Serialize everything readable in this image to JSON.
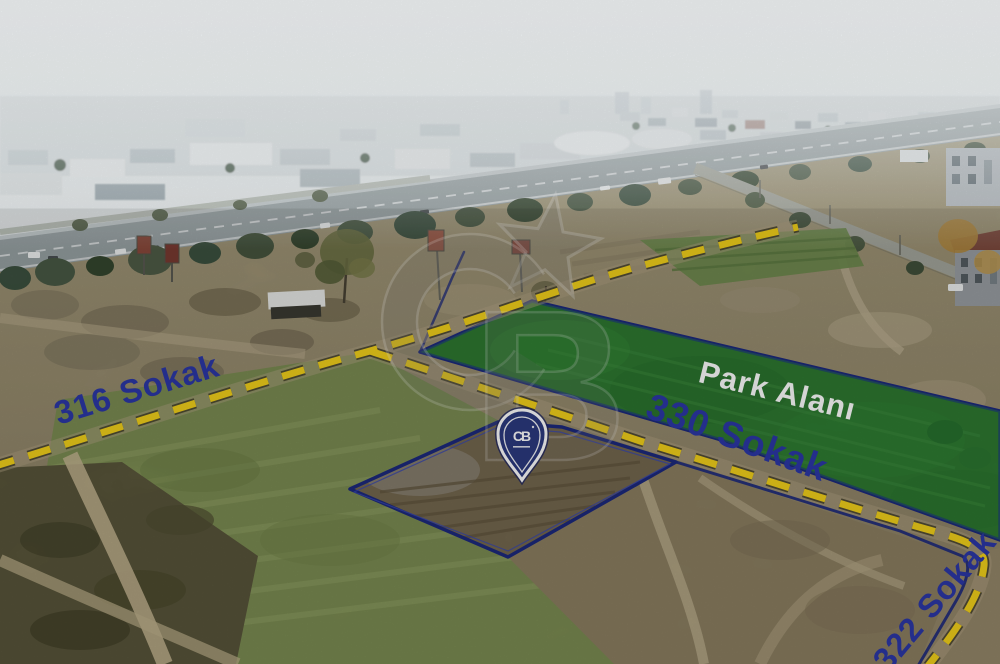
{
  "labels": {
    "park": "Park Alanı",
    "streets": [
      {
        "name": "316 Sokak"
      },
      {
        "name": "330 Sokak"
      },
      {
        "name": "322 Sokak"
      }
    ]
  },
  "watermark": {
    "letter_c": "C",
    "letter_b": "B"
  },
  "pin": {
    "logo_text": "CB"
  },
  "colors": {
    "street_label": "#2c38a8",
    "street_dash": "#f4d21c",
    "boundary_line": "#1d2a7e",
    "park_fill": "rgba(45,150,60,0.35)",
    "park_label": "#ffffff",
    "pin_fill": "#2c3a80",
    "pin_border": "#ffffff"
  }
}
